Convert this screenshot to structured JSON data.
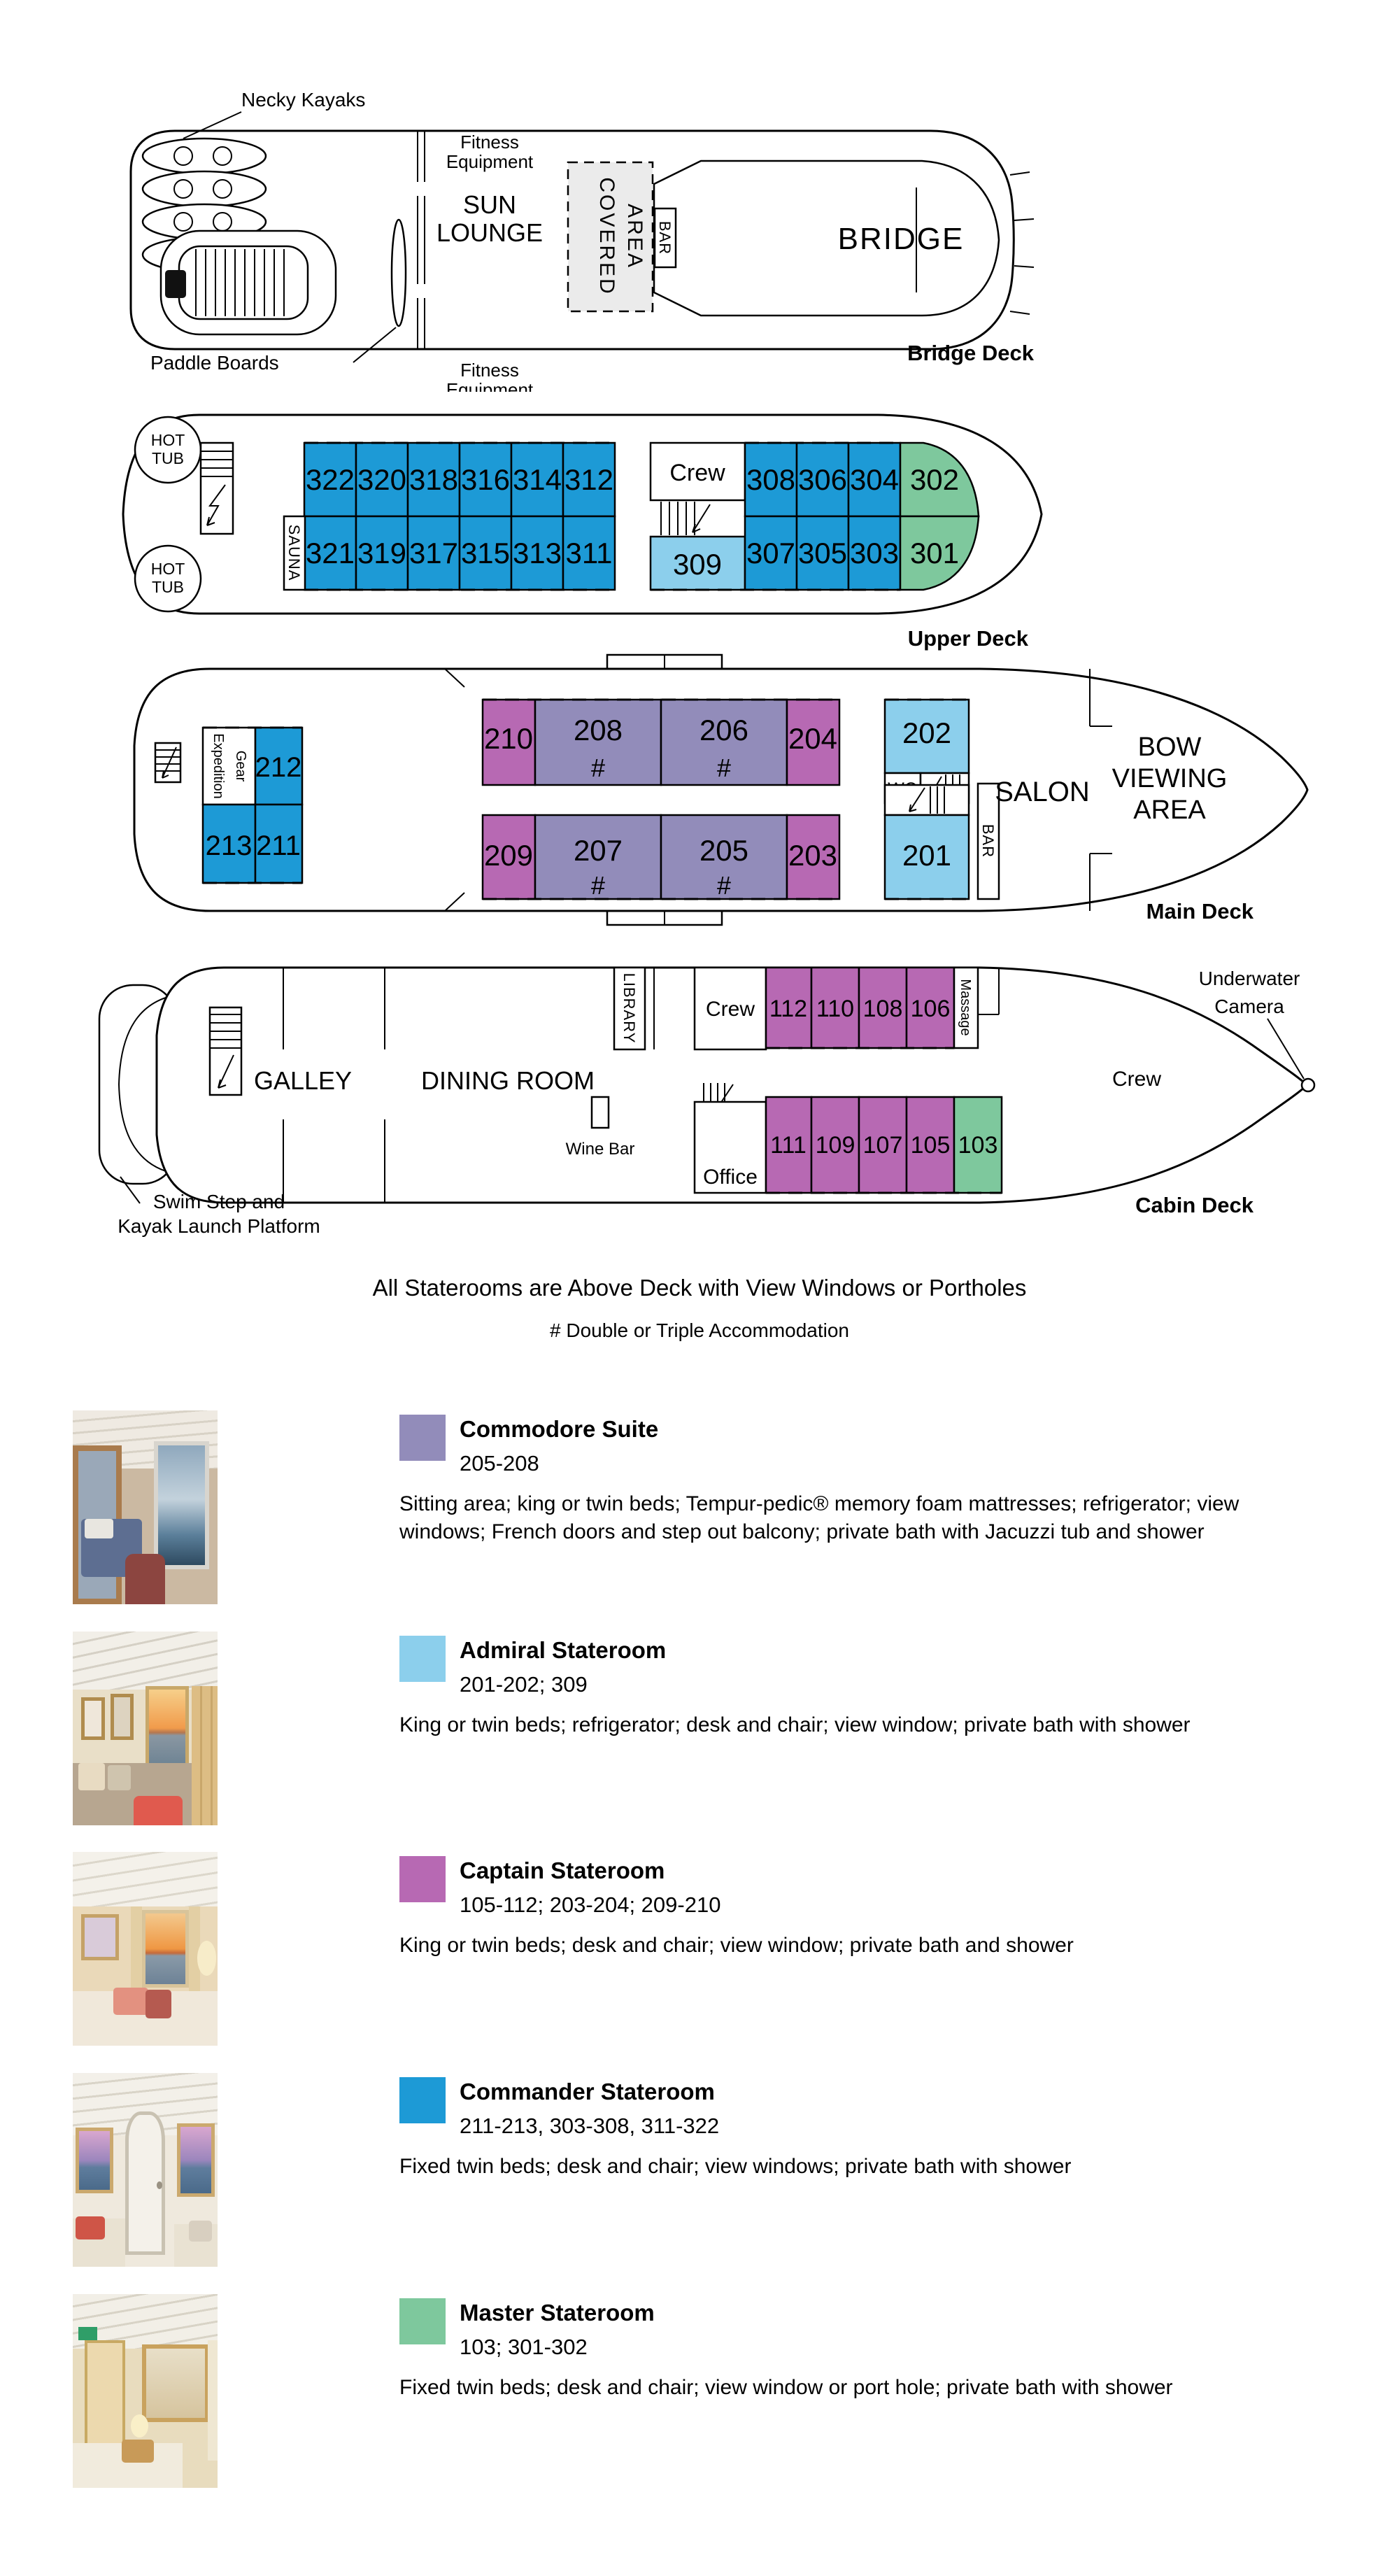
{
  "colors": {
    "commodore": "#928cba",
    "admiral": "#8ccfec",
    "captain": "#b769b3",
    "commander": "#1d9ad6",
    "master": "#7ec89d"
  },
  "bridge": {
    "kayaks": "Necky Kayaks",
    "paddle": "Paddle Boards",
    "fitness1": "Fitness",
    "fitness2": "Equipment",
    "sun1": "SUN",
    "sun2": "LOUNGE",
    "covered1": "COVERED",
    "covered2": "AREA",
    "bar": "BAR",
    "bridge": "BRIDGE",
    "deck": "Bridge Deck"
  },
  "upper": {
    "hot1": "HOT",
    "hot2": "TUB",
    "sauna": "SAUNA",
    "crew": "Crew",
    "m": "309",
    "g1": "302",
    "g2": "301",
    "deck": "Upper Deck",
    "top": [
      "322",
      "320",
      "318",
      "316",
      "314",
      "312"
    ],
    "bottom": [
      "321",
      "319",
      "317",
      "315",
      "313",
      "311"
    ],
    "rtop": [
      "308",
      "306",
      "304"
    ],
    "rbottom": [
      "307",
      "305",
      "303"
    ]
  },
  "main": {
    "exp1": "Expedition",
    "exp2": "Gear",
    "wc": "WC",
    "bar": "BAR",
    "salon": "SALON",
    "bow1": "BOW",
    "bow2": "VIEWING",
    "bow3": "AREA",
    "hash": "#",
    "deck": "Main Deck",
    "l212": "212",
    "l213": "213",
    "l211": "211",
    "m202": "202",
    "m201": "201",
    "top": [
      "210",
      "208",
      "206",
      "204"
    ],
    "bottom": [
      "209",
      "207",
      "205",
      "203"
    ]
  },
  "cabin": {
    "galley": "GALLEY",
    "dining": "DINING ROOM",
    "library": "LIBRARY",
    "crew": "Crew",
    "crew2": "Crew",
    "massage": "Massage",
    "wine": "Wine Bar",
    "office": "Office",
    "uw1": "Underwater",
    "uw2": "Camera",
    "swim1": "Swim Step and",
    "swim2": "Kayak Launch Platform",
    "deck": "Cabin Deck",
    "green": "103",
    "top": [
      "112",
      "110",
      "108",
      "106"
    ],
    "bottom": [
      "111",
      "109",
      "107",
      "105"
    ]
  },
  "notes": {
    "line1": "All Staterooms are Above Deck with View Windows or Portholes",
    "line2": "# Double or Triple Accommodation"
  },
  "legend": [
    {
      "name": "Commodore Suite",
      "rooms": "205-208",
      "desc": "Sitting area; king or twin beds; Tempur-pedic® memory foam mattresses; refrigerator; view windows; French doors and step out balcony; private bath with Jacuzzi tub and shower"
    },
    {
      "name": "Admiral Stateroom",
      "rooms": "201-202; 309",
      "desc": "King or twin beds; refrigerator; desk and chair; view window; private bath with shower"
    },
    {
      "name": "Captain Stateroom",
      "rooms": "105-112; 203-204; 209-210",
      "desc": "King or twin beds; desk and chair; view window; private bath and shower"
    },
    {
      "name": "Commander Stateroom",
      "rooms": "211-213, 303-308, 311-322",
      "desc": "Fixed twin beds; desk and chair; view windows; private bath with shower"
    },
    {
      "name": "Master Stateroom",
      "rooms": "103; 301-302",
      "desc": "Fixed twin beds; desk and chair; view window or port hole; private bath with shower"
    }
  ]
}
